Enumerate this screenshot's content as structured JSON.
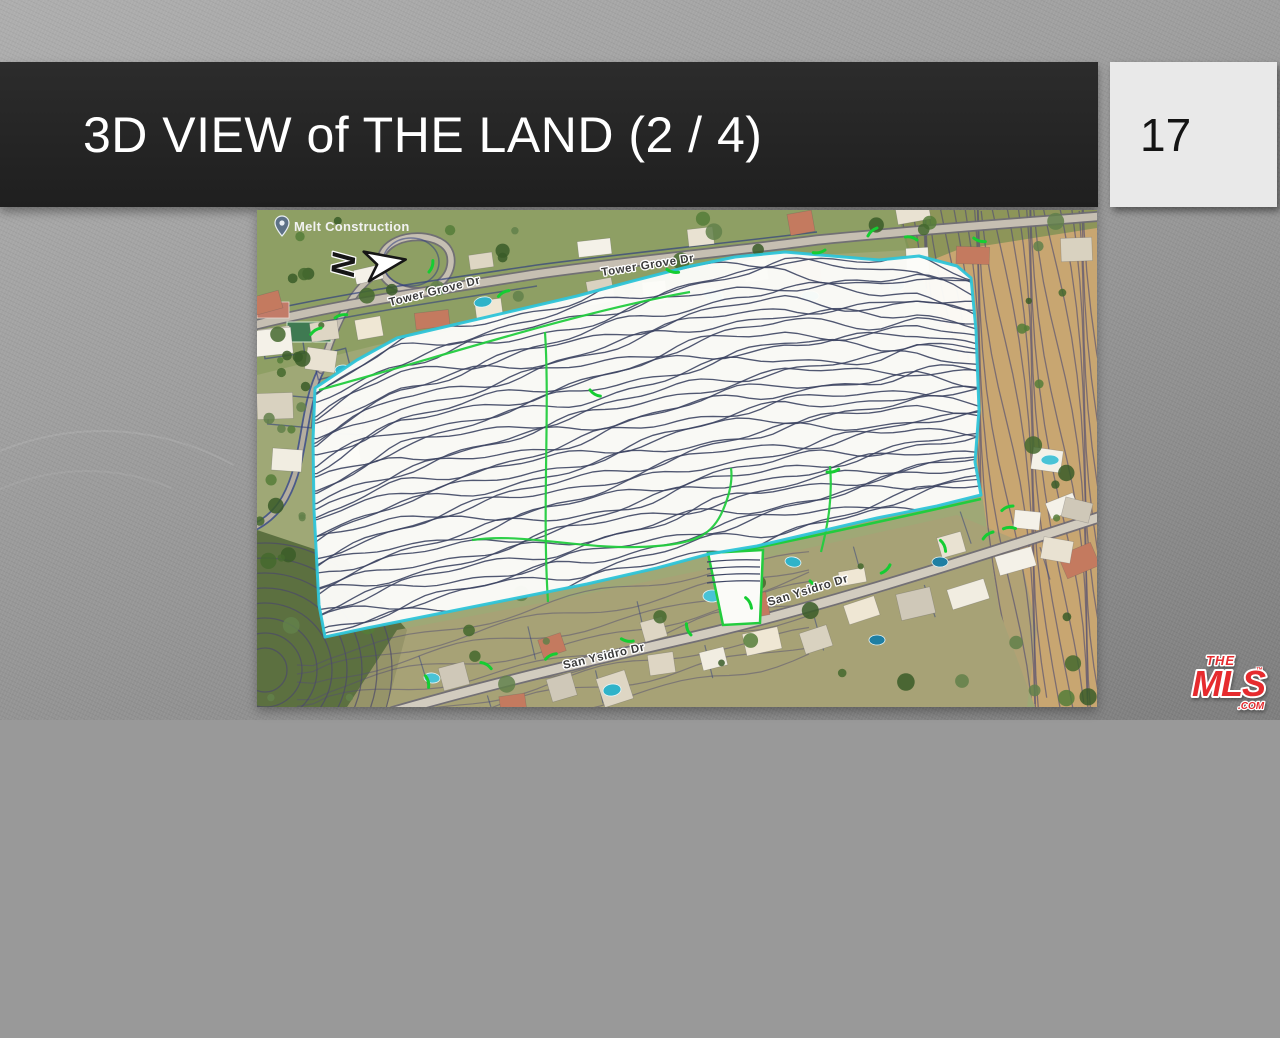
{
  "slide": {
    "title": "3D VIEW of THE LAND (2 / 4)",
    "page_number": "17"
  },
  "map": {
    "place_label": "Melt Construction",
    "north_label": "N",
    "streets": {
      "tower_grove_a": "Tower Grove Dr",
      "tower_grove_b": "Tower Grove Dr",
      "san_ysidro_a": "San Ysidro Dr",
      "san_ysidro_b": "San Ysidro Dr"
    },
    "colors": {
      "parcel_outline_cyan": "#2ec4d8",
      "parcel_outline_green": "#22cc3e",
      "contour_line": "#3d4563",
      "hillside_contour": "#534e72",
      "terrain_green": "#9fa876",
      "terrain_tan": "#c8a671",
      "bright_green": "#15cd32"
    }
  },
  "logo": {
    "line1": "THE",
    "line2": "MLS",
    "tm": "™",
    "suffix": ".COM"
  }
}
